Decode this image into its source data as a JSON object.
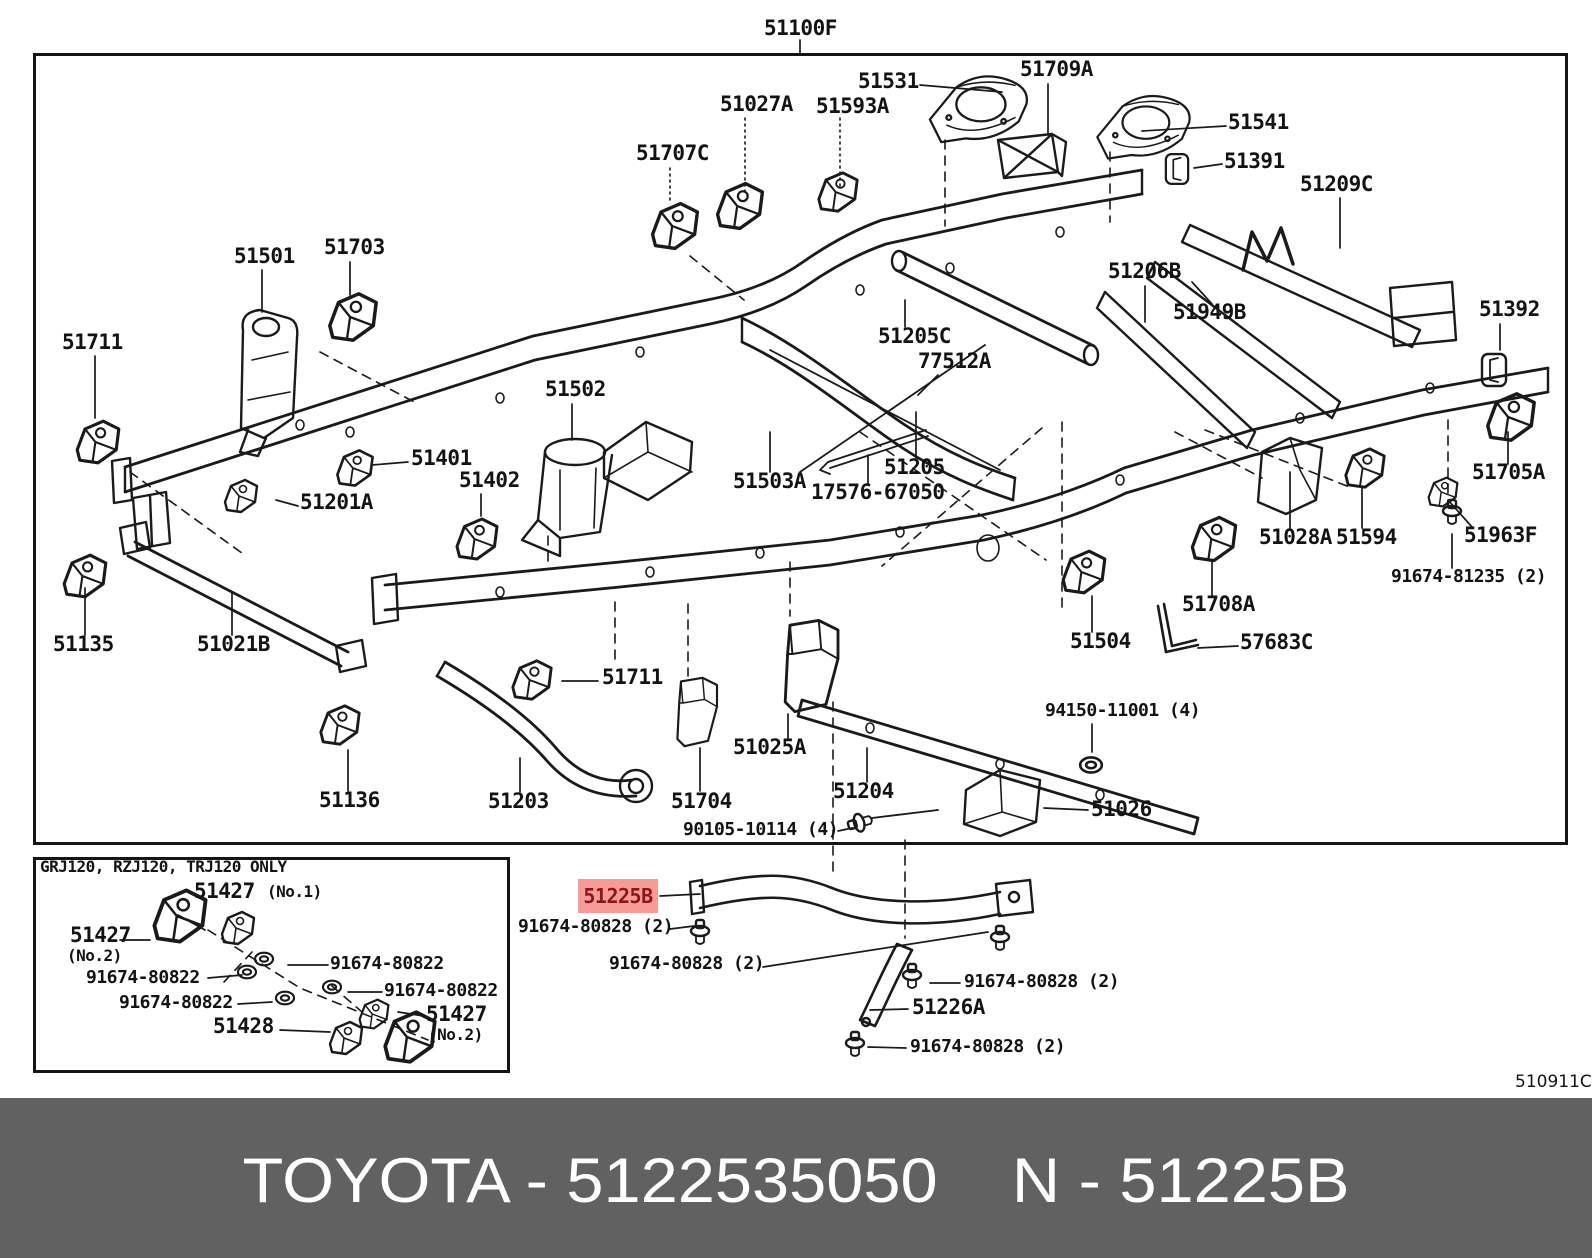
{
  "banner": {
    "bg": "#616161",
    "text": "TOYOTA - 5122535050    N - 51225B",
    "left": "TOYOTA - 5122535050",
    "right": "N - 51225B"
  },
  "highlight": {
    "text": "51225B",
    "bg": "#F79B99",
    "fg": "#8C1616"
  },
  "inset_header": "GRJ120, RZJ120, TRJ120 ONLY",
  "diagram_code": "510911C",
  "main_assembly": "51100F",
  "labels": [
    {
      "t": "51100F",
      "x": 764,
      "y": 18,
      "c": "lg"
    },
    {
      "t": "51531",
      "x": 858,
      "y": 71,
      "c": "lg"
    },
    {
      "t": "51709A",
      "x": 1020,
      "y": 59,
      "c": "lg"
    },
    {
      "t": "51027A",
      "x": 720,
      "y": 94,
      "c": "lg"
    },
    {
      "t": "51593A",
      "x": 816,
      "y": 96,
      "c": "lg"
    },
    {
      "t": "51707C",
      "x": 636,
      "y": 143,
      "c": "lg"
    },
    {
      "t": "51541",
      "x": 1228,
      "y": 112,
      "c": "lg"
    },
    {
      "t": "51391",
      "x": 1224,
      "y": 151,
      "c": "lg"
    },
    {
      "t": "51209C",
      "x": 1300,
      "y": 174,
      "c": "lg"
    },
    {
      "t": "51501",
      "x": 234,
      "y": 246,
      "c": "lg"
    },
    {
      "t": "51703",
      "x": 324,
      "y": 237,
      "c": "lg"
    },
    {
      "t": "51206B",
      "x": 1108,
      "y": 261,
      "c": "lg"
    },
    {
      "t": "51949B",
      "x": 1173,
      "y": 302,
      "c": "lg"
    },
    {
      "t": "51711",
      "x": 62,
      "y": 332,
      "c": "lg"
    },
    {
      "t": "51392",
      "x": 1479,
      "y": 299,
      "c": "lg"
    },
    {
      "t": "51502",
      "x": 545,
      "y": 379,
      "c": "lg"
    },
    {
      "t": "51401",
      "x": 411,
      "y": 448,
      "c": "lg"
    },
    {
      "t": "51402",
      "x": 459,
      "y": 470,
      "c": "lg"
    },
    {
      "t": "51201A",
      "x": 300,
      "y": 492,
      "c": "lg"
    },
    {
      "t": "51205C",
      "x": 878,
      "y": 326,
      "c": "lg"
    },
    {
      "t": "77512A",
      "x": 918,
      "y": 351,
      "c": "lg"
    },
    {
      "t": "51503A",
      "x": 733,
      "y": 471,
      "c": "lg"
    },
    {
      "t": "17576-67050",
      "x": 811,
      "y": 482,
      "c": "lg"
    },
    {
      "t": "51205",
      "x": 884,
      "y": 457,
      "c": "lg"
    },
    {
      "t": "51705A",
      "x": 1472,
      "y": 462,
      "c": "lg"
    },
    {
      "t": "51028A",
      "x": 1259,
      "y": 527,
      "c": "lg"
    },
    {
      "t": "51594",
      "x": 1336,
      "y": 527,
      "c": "lg"
    },
    {
      "t": "51963F",
      "x": 1464,
      "y": 525,
      "c": "lg"
    },
    {
      "t": "91674-81235 (2)",
      "x": 1391,
      "y": 568,
      "c": "sm"
    },
    {
      "t": "51708A",
      "x": 1182,
      "y": 594,
      "c": "lg"
    },
    {
      "t": "51135",
      "x": 53,
      "y": 634,
      "c": "lg"
    },
    {
      "t": "51021B",
      "x": 197,
      "y": 634,
      "c": "lg"
    },
    {
      "t": "51504",
      "x": 1070,
      "y": 631,
      "c": "lg"
    },
    {
      "t": "57683C",
      "x": 1240,
      "y": 632,
      "c": "lg"
    },
    {
      "t": "51711",
      "x": 602,
      "y": 667,
      "c": "lg"
    },
    {
      "t": "94150-11001 (4)",
      "x": 1045,
      "y": 702,
      "c": "sm"
    },
    {
      "t": "51025A",
      "x": 733,
      "y": 737,
      "c": "lg"
    },
    {
      "t": "51136",
      "x": 319,
      "y": 790,
      "c": "lg"
    },
    {
      "t": "51203",
      "x": 488,
      "y": 791,
      "c": "lg"
    },
    {
      "t": "51704",
      "x": 671,
      "y": 791,
      "c": "lg"
    },
    {
      "t": "51204",
      "x": 833,
      "y": 781,
      "c": "lg"
    },
    {
      "t": "51026",
      "x": 1091,
      "y": 799,
      "c": "lg"
    },
    {
      "t": "90105-10114 (4)",
      "x": 683,
      "y": 821,
      "c": "sm"
    },
    {
      "t": "91674-80828 (2)",
      "x": 518,
      "y": 918,
      "c": "sm"
    },
    {
      "t": "91674-80828 (2)",
      "x": 609,
      "y": 955,
      "c": "sm"
    },
    {
      "t": "91674-80828 (2)",
      "x": 964,
      "y": 973,
      "c": "sm"
    },
    {
      "t": "51226A",
      "x": 912,
      "y": 997,
      "c": "lg"
    },
    {
      "t": "91674-80828 (2)",
      "x": 910,
      "y": 1038,
      "c": "sm"
    },
    {
      "t": "GRJ120, RZJ120, TRJ120 ONLY",
      "x": 40,
      "y": 859,
      "c": "hdr"
    },
    {
      "t": "51427",
      "x": 194,
      "y": 881,
      "c": "lg"
    },
    {
      "t": "(No.1)",
      "x": 267,
      "y": 884,
      "c": "no"
    },
    {
      "t": "51427",
      "x": 70,
      "y": 925,
      "c": "lg"
    },
    {
      "t": "(No.2)",
      "x": 67,
      "y": 948,
      "c": "no"
    },
    {
      "t": "91674-80822",
      "x": 330,
      "y": 955,
      "c": "sm"
    },
    {
      "t": "91674-80822",
      "x": 86,
      "y": 969,
      "c": "sm"
    },
    {
      "t": "91674-80822",
      "x": 384,
      "y": 982,
      "c": "sm"
    },
    {
      "t": "91674-80822",
      "x": 119,
      "y": 994,
      "c": "sm"
    },
    {
      "t": "51428",
      "x": 213,
      "y": 1016,
      "c": "lg"
    },
    {
      "t": "51427",
      "x": 426,
      "y": 1004,
      "c": "lg"
    },
    {
      "t": "(No.2)",
      "x": 428,
      "y": 1027,
      "c": "no"
    },
    {
      "t": "510911C",
      "x": 1515,
      "y": 1074,
      "c": "code"
    }
  ]
}
